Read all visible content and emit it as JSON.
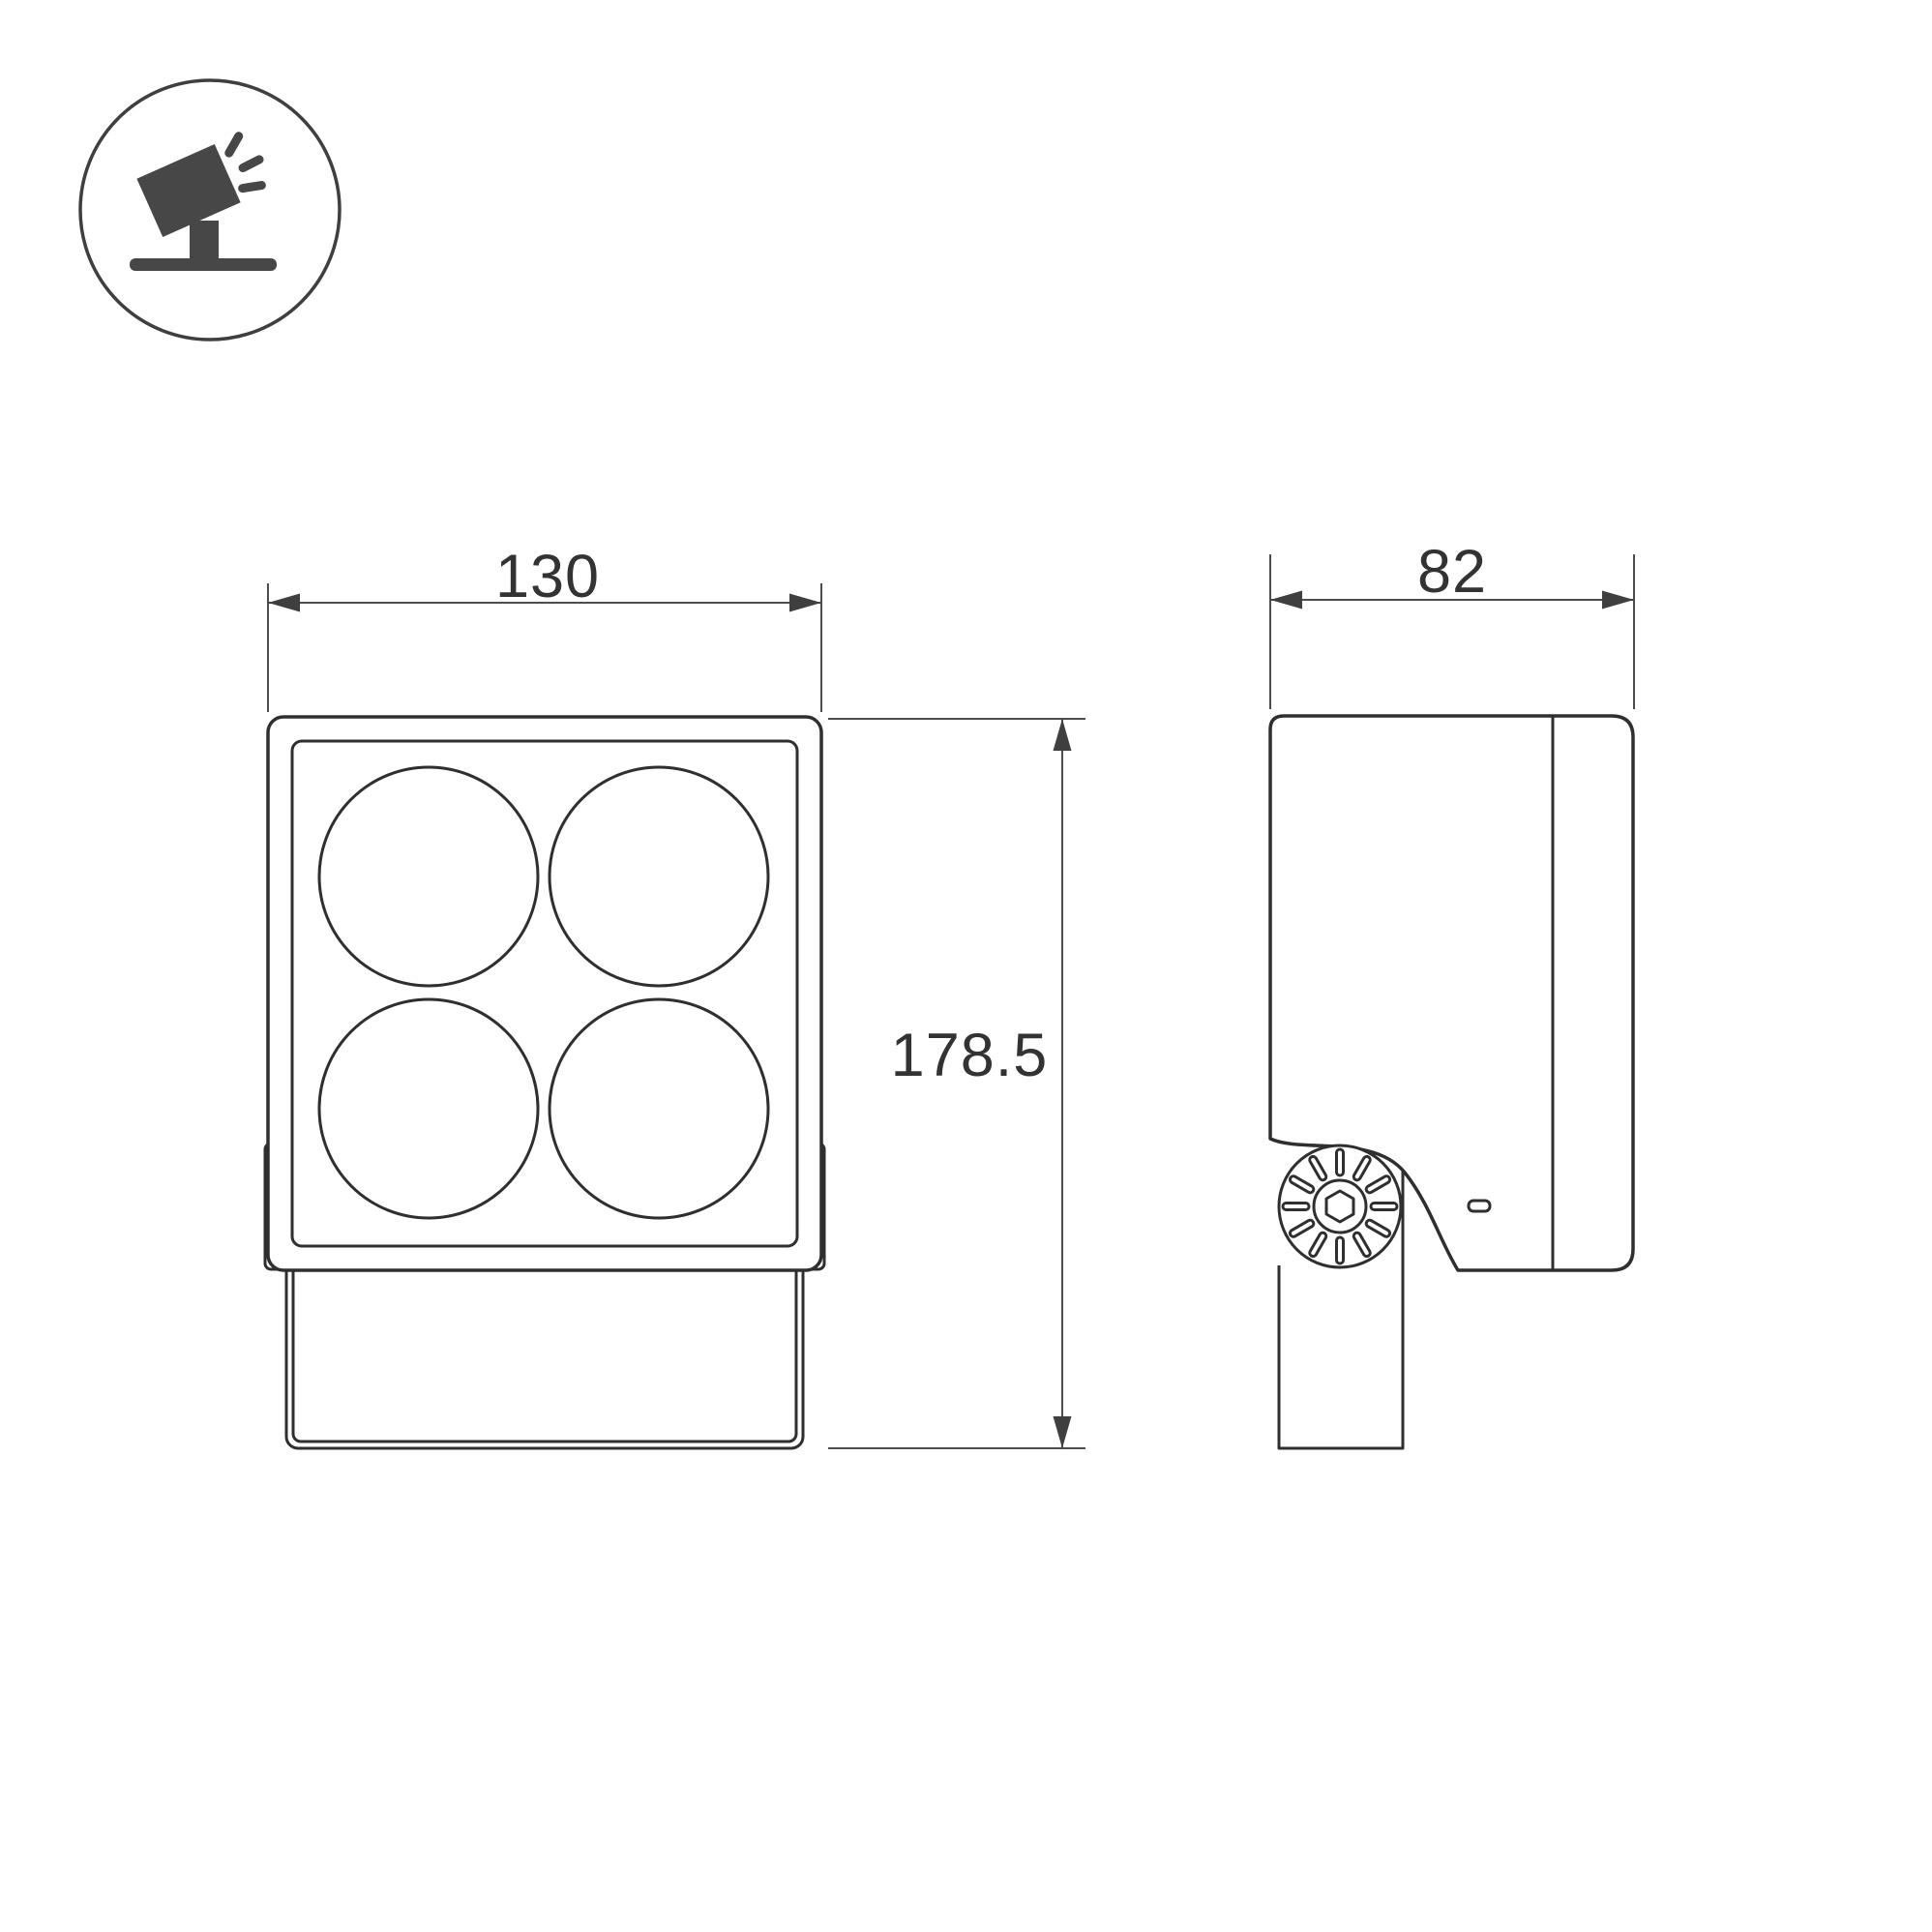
{
  "page": {
    "background_color": "#ffffff",
    "outline_color": "#2f2f2f",
    "dimension_line_color": "#4d4d4d",
    "dimension_text_color": "#333333",
    "icon_color": "#474747"
  },
  "icon": {
    "name": "tilted-floodlight-on-ground-icon"
  },
  "drawing": {
    "dimensions": {
      "front_width": {
        "value": "130"
      },
      "overall_height": {
        "value": "178.5"
      },
      "side_depth": {
        "value": "82"
      }
    },
    "front_view": {
      "lens_count": 4
    },
    "side_view": {
      "knob_slot_count": 12
    }
  }
}
